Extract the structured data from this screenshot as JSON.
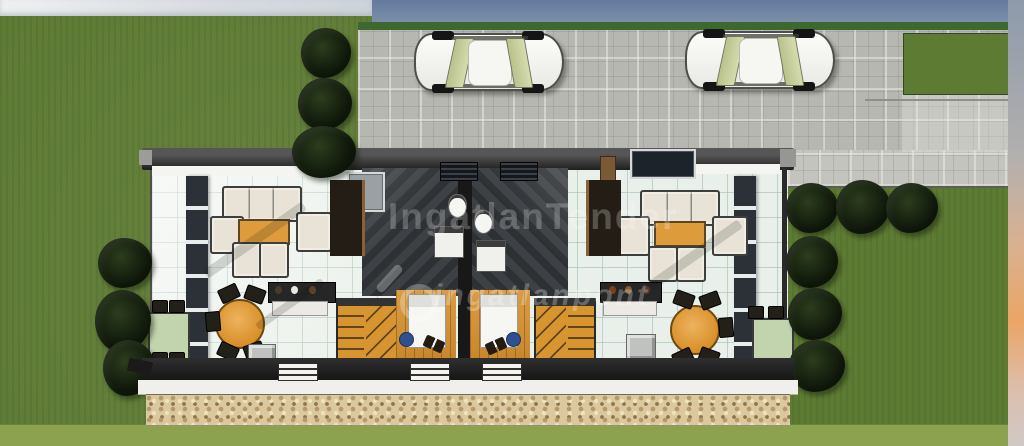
{
  "meta": {
    "kind": "3d-duplex-floorplan-render",
    "units": 2
  },
  "watermarks": {
    "primary": "IngatlanTender",
    "secondary": "ingatlanpont"
  },
  "colors": {
    "grass": "#5e7b34",
    "grass_light": "#8ca24f",
    "hedge": "#3f6730",
    "sky_blue": "#64799c",
    "pavement": "#b6b7b0",
    "pavement_light": "#c3c4bd",
    "tile": "#edf2ec",
    "wall": "#1f1f1f",
    "glass_wall": "#2b3136",
    "wood": "#d8942f",
    "wood_floor": "#c9872c",
    "table_wood": "#dd9b3c",
    "stone": "#dbc89f",
    "patio_table": "#c2d4ae",
    "car_body": "#e9e9e4",
    "car_glass": "#d6dcae",
    "tree": "#0d1409"
  }
}
